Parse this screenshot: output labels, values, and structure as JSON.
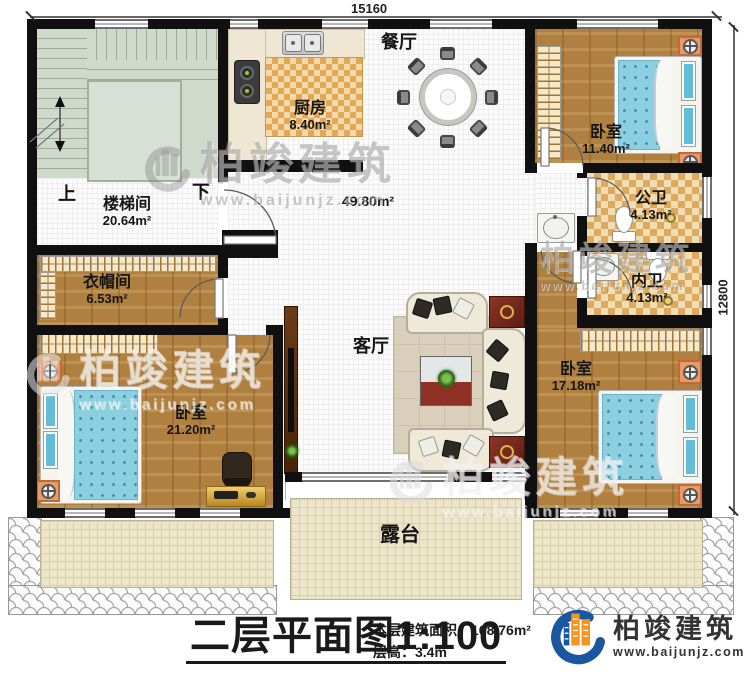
{
  "dimension_labels": {
    "top": "15160",
    "right": "12800"
  },
  "stairs": {
    "up": "上",
    "down": "下"
  },
  "rooms": {
    "stairwell": {
      "name": "楼梯间",
      "area": "20.64m²"
    },
    "kitchen": {
      "name": "厨房",
      "area": "8.40m²"
    },
    "dining": {
      "name": "餐厅"
    },
    "living": {
      "name": "客厅",
      "area": "49.80m²"
    },
    "bedroom_top_right": {
      "name": "卧室",
      "area": "11.40m²"
    },
    "public_bath": {
      "name": "公卫",
      "area": "4.13m²"
    },
    "private_bath": {
      "name": "内卫",
      "area": "4.13m²"
    },
    "cloakroom": {
      "name": "衣帽间",
      "area": "6.53m²"
    },
    "bedroom_bottom_left": {
      "name": "卧室",
      "area": "21.20m²"
    },
    "bedroom_bottom_right": {
      "name": "卧室",
      "area": "17.18m²"
    },
    "terrace": {
      "name": "露台"
    }
  },
  "title_block": {
    "plan_title": "二层平面图",
    "scale": "1:100",
    "floor_area_label": "本层建筑面积：",
    "floor_area_value": "168.76m²",
    "floor_height_label": "层高：",
    "floor_height_value": "3.4m"
  },
  "brand": {
    "name": "柏竣建筑",
    "website": "www.baijunjz.com"
  },
  "watermark": {
    "name": "柏竣建筑",
    "website": "www.baijunjz.com"
  },
  "colors": {
    "brand_blue": "#1a57a0",
    "brand_orange": "#f7941d",
    "bed_blue": "#8bcfe0",
    "wood": "#b08040",
    "bath_tile": "#dca95e"
  }
}
